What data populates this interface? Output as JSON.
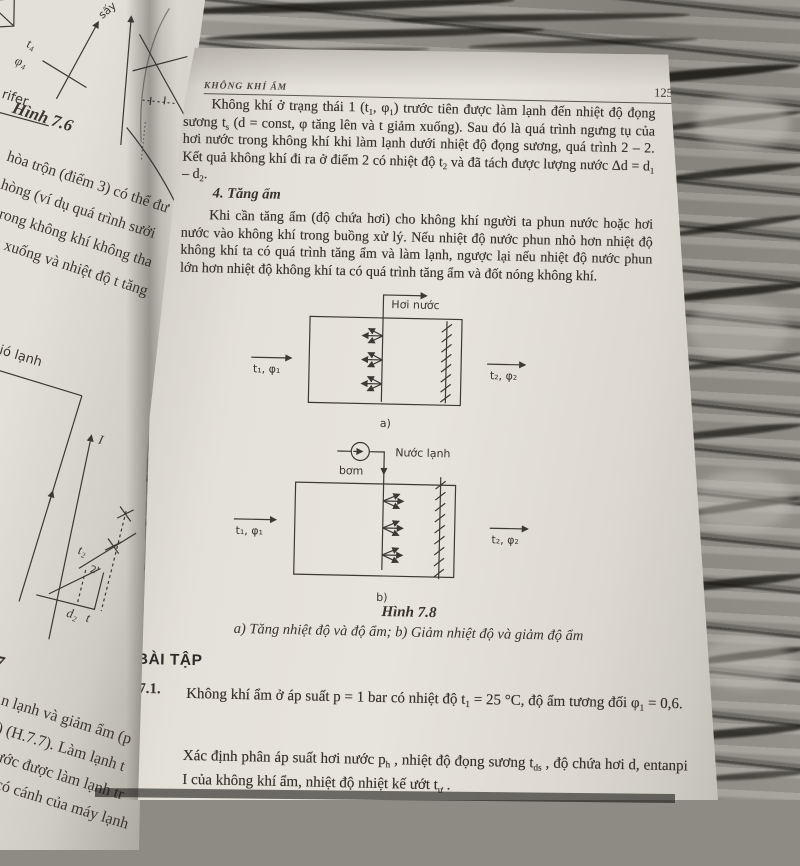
{
  "left_page": {
    "figure_7_6": {
      "caption": "Hình 7.6",
      "labels": {
        "say": "sấy",
        "t4": "t₄",
        "phi4": "φ₄",
        "calorifer_fragment": "rifer"
      }
    },
    "text_fragments": [
      "hòa trộn (điểm 3) có thể đư",
      "hòng (ví dụ quá trình sưởi",
      "trong không khí không tha",
      "m xuống và nhiệt độ t tăng"
    ],
    "gio_lanh_label": "Gió lạnh",
    "chart_labels": {
      "axis_i": "I",
      "t2": "t₂",
      "point2": "2'",
      "d2": "d₂",
      "t": "t"
    },
    "bottom_fragments": [
      "7",
      "n lạnh và giảm ẩm (p",
      ") (H.7.7). Làm lạnh t",
      "ước được làm lạnh tr",
      "có cánh của máy lạnh"
    ]
  },
  "right_page": {
    "header": {
      "running_title": "KHÔNG KHÍ ẨM",
      "page_number": "125"
    },
    "para1": "Không khí ở trạng thái 1 (t~1~, φ~1~) trước tiên được làm lạnh đến nhiệt độ đọng sương t~s~ (d = const, φ tăng lên và t giảm xuống). Sau đó là quá trình ngưng tụ của hơi nước trong không khí khi làm lạnh dưới nhiệt độ đọng sương, quá trình 2 – 2. Kết quả không khí đi ra ở điểm 2 có nhiệt độ t~2~ và đã tách được lượng nước Δd = d~1~ – d~2~.",
    "section_heading": "4. Tăng ẩm",
    "para2": "Khi cần tăng ẩm (độ chứa hơi) cho không khí người ta phun nước hoặc hơi nước vào không khí trong buồng xử lý. Nếu nhiệt độ nước phun nhỏ hơn nhiệt độ không khí ta có quá trình tăng ẩm và làm lạnh, ngược lại nếu nhiệt độ nước phun lớn hơn nhiệt độ không khí ta có quá trình tăng ẩm và đốt nóng không khí.",
    "figure_a": {
      "steam_label": "Hơi nước",
      "inlet": "t₁, φ₁",
      "outlet": "t₂, φ₂",
      "sub_label": "a)"
    },
    "figure_b": {
      "pump_label": "bơm",
      "water_label": "Nước lạnh",
      "inlet": "t₁, φ₁",
      "outlet": "t₂, φ₂",
      "sub_label": "b)"
    },
    "figure_caption": {
      "title": "Hình 7.8",
      "subtitle": "a) Tăng nhiệt độ và độ ẩm;  b) Giảm nhiệt độ và giảm độ ẩm"
    },
    "exercises": {
      "heading": "BÀI TẬP",
      "ex1_number": "7.1.",
      "ex1_text": "Không khí ẩm ở áp suất p = 1 bar có nhiệt độ t~1~ = 25 °C, độ ẩm tương đối φ~1~ = 0,6.",
      "ex1_text2": "Xác định phân áp suất hơi nước p~h~ , nhiệt độ đọng sương t~ds~ , độ chứa hơi d, entanpi I của không khí ẩm, nhiệt độ nhiệt kế ướt t~ư~ ."
    }
  }
}
